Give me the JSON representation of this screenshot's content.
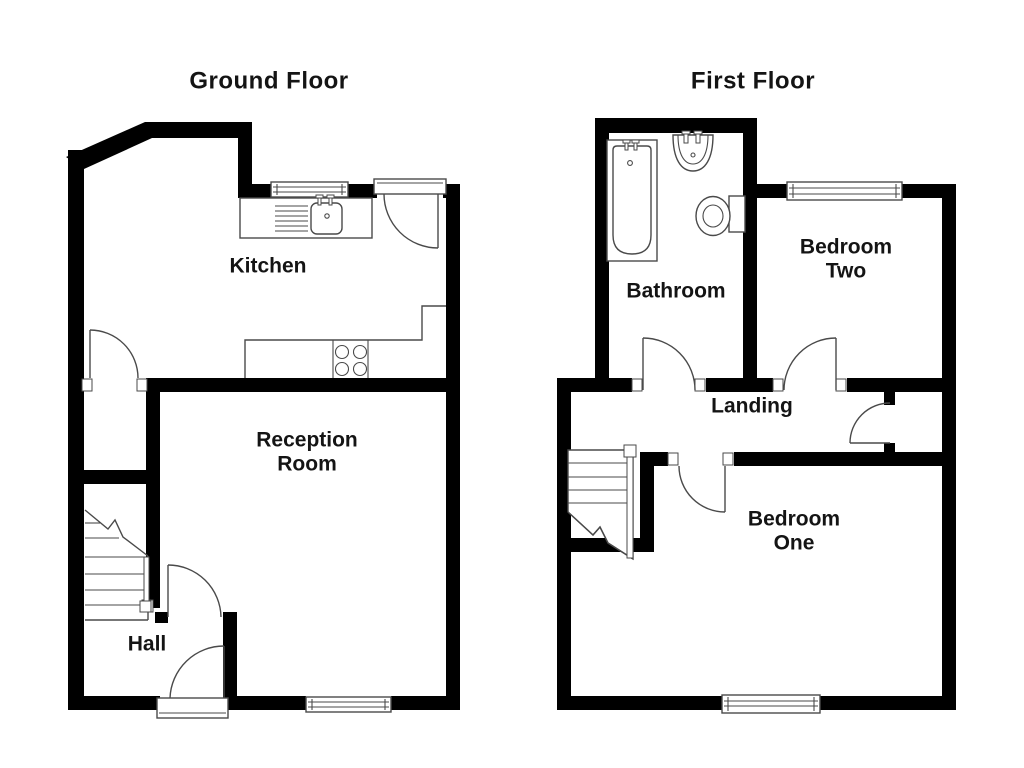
{
  "document": {
    "type": "property-floorplan"
  },
  "colors": {
    "wall": "#000000",
    "outline": "#4a4a4a",
    "background": "#ffffff",
    "text": "#141414"
  },
  "ground_floor": {
    "title": "Ground Floor",
    "rooms": {
      "kitchen": "Kitchen",
      "reception_line1": "Reception",
      "reception_line2": "Room",
      "hall": "Hall"
    },
    "fixtures": [
      "kitchen-sink",
      "draining-board",
      "sink-window",
      "worktop",
      "hob",
      "staircase",
      "front-door",
      "reception-window",
      "under-stairs-closet"
    ]
  },
  "first_floor": {
    "title": "First Floor",
    "rooms": {
      "bathroom": "Bathroom",
      "bedroom_two_line1": "Bedroom",
      "bedroom_two_line2": "Two",
      "landing": "Landing",
      "bedroom_one_line1": "Bedroom",
      "bedroom_one_line2": "One"
    },
    "fixtures": [
      "bath",
      "basin",
      "toilet",
      "staircase",
      "bedroom-two-window",
      "bedroom-one-window",
      "landing-cupboard"
    ]
  }
}
